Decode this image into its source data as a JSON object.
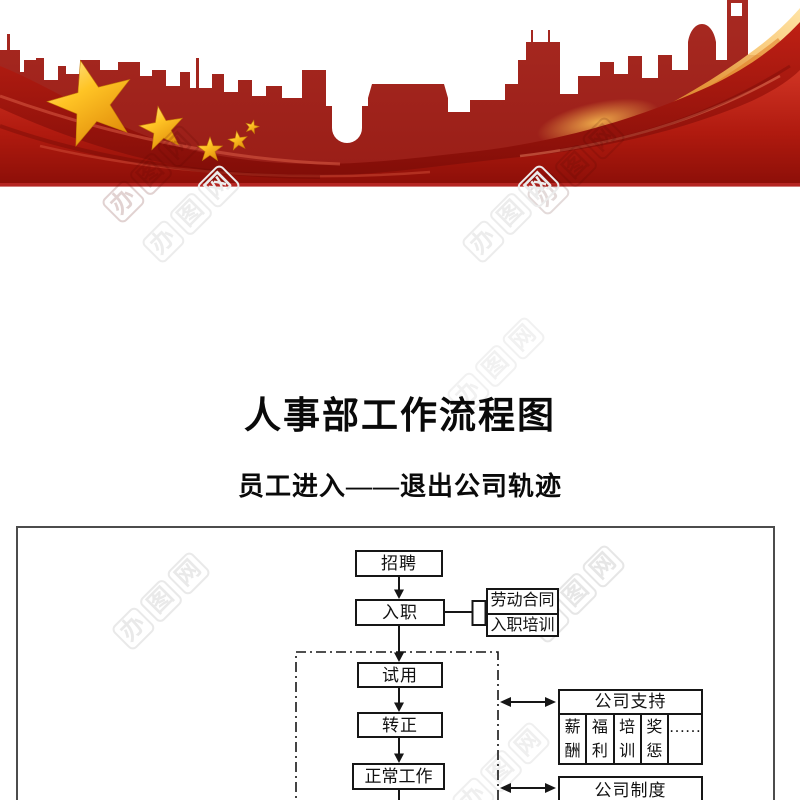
{
  "title": {
    "text": "人事部工作流程图"
  },
  "subtitle": {
    "text": "员工进入——退出公司轨迹"
  },
  "banner": {
    "colors": {
      "skyline_red": "#a1241e",
      "ribbon_red": "#bf2014",
      "ribbon_dark": "#7e0c07",
      "flare_orange": "#f0a83d",
      "star_gold": "#ffc425",
      "bottom_strip": "#b52622"
    }
  },
  "flowchart": {
    "main_nodes": {
      "recruit": "招聘",
      "onboard": "入职",
      "probation": "试用",
      "regularize": "转正",
      "normal_work": "正常工作"
    },
    "onboard_attachments": {
      "labor_contract": "劳动合同",
      "onboard_training": "入职培训"
    },
    "support": {
      "header": "公司支持",
      "cells": [
        "薪酬",
        "福利",
        "培训",
        "奖惩",
        "……"
      ]
    },
    "system": {
      "header": "公司制度"
    },
    "edges": [
      "招聘→入职",
      "入职→劳动合同/入职培训",
      "入职→试用",
      "试用→转正",
      "转正→正常工作",
      "试用期区域↔公司支持",
      "工作区域↔公司制度"
    ]
  },
  "watermark": {
    "chars": [
      "办",
      "图",
      "网"
    ]
  }
}
